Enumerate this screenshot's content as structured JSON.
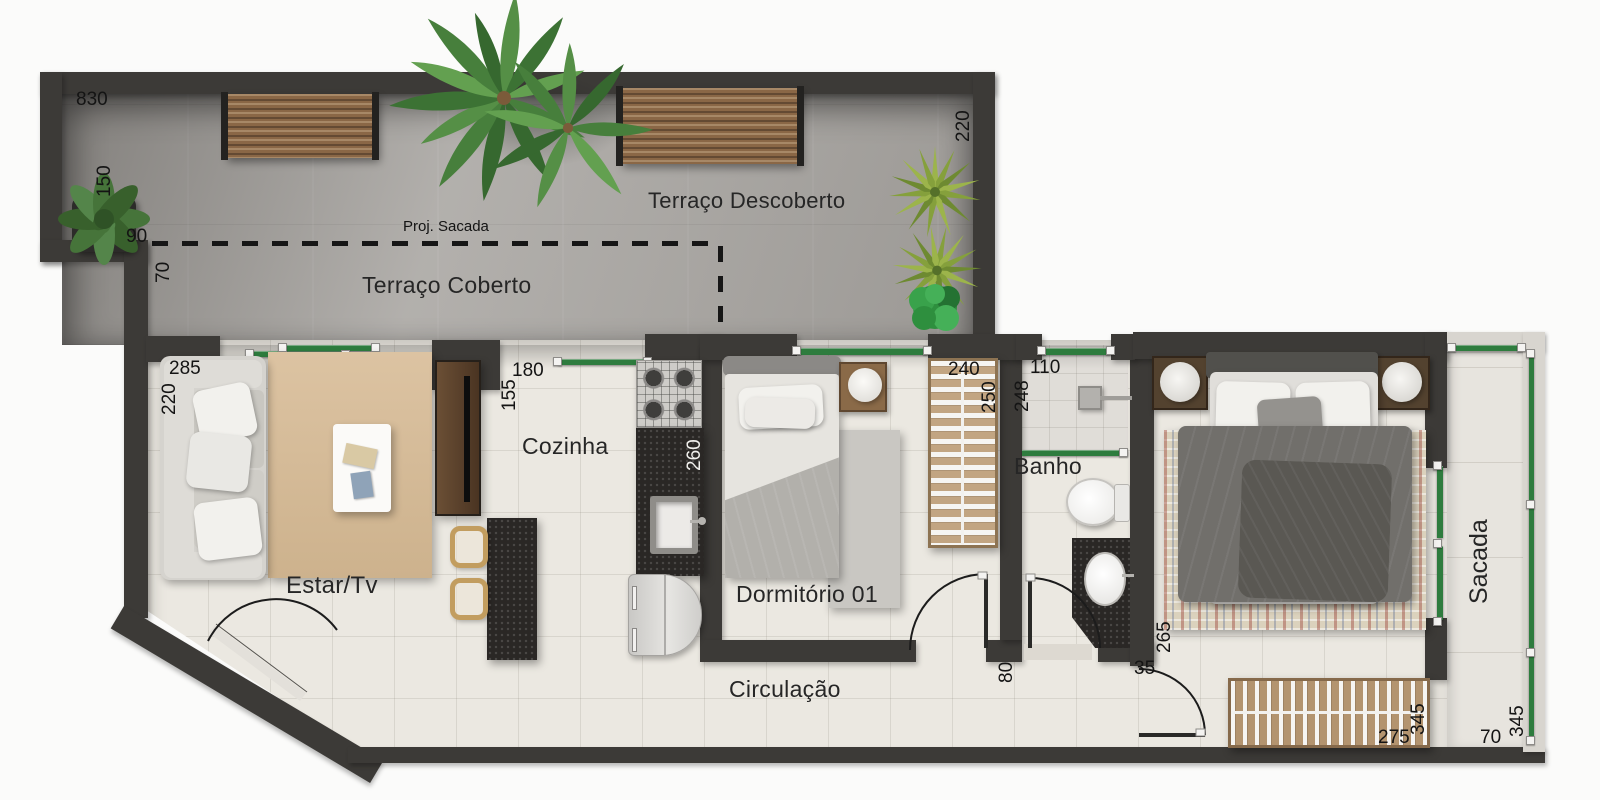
{
  "page": {
    "type": "architectural-floor-plan",
    "language": "pt-BR"
  },
  "labels": {
    "terraco_descoberto": "Terraço Descoberto",
    "terraco_coberto": "Terraço Coberto",
    "proj_sacada": "Proj. Sacada",
    "estar_tv": "Estar/Tv",
    "cozinha": "Cozinha",
    "dormitorio_01": "Dormitório 01",
    "banho": "Banho",
    "circulacao": "Circulação",
    "sacada": "Sacada"
  },
  "dims": {
    "terrace_width": "830",
    "terrace_left": "150",
    "terrace_right": "220",
    "step_width": "90",
    "step_depth": "70",
    "estar_width": "285",
    "estar_depth": "220",
    "cozinha_width": "180",
    "cozinha_left": "155",
    "counter_len": "260",
    "closet1_width": "240",
    "closet1_side": "250",
    "banho_width": "110",
    "banho_depth": "248",
    "circ_width": "80",
    "door_jamb": "35",
    "dorm2_side": "265",
    "closet2_width": "275",
    "dorm2_width": "345",
    "sacada_len": "345",
    "sacada_width": "70"
  },
  "colors": {
    "wall": "#3c3a37",
    "glass_green": "#2e7c3e",
    "terrace_floor": "#aaa7a3",
    "apartment_floor": "#ebe8e1",
    "bench_wood": "#8a6746",
    "rug_living": "#d6bd9c",
    "granite": "#2a2725",
    "label_text": "#141414"
  },
  "furniture": [
    "garden-bench",
    "palm-tree",
    "fern-plant",
    "yucca-plant",
    "round-bush",
    "sofa",
    "throw-pillows",
    "living-rug",
    "coffee-table",
    "tv-console",
    "dining-table",
    "dining-chair",
    "stove",
    "kitchen-counter",
    "kitchen-sink",
    "refrigerator",
    "single-bed",
    "nightstand",
    "bedroom-rug",
    "open-wardrobe",
    "shower-head",
    "shower-glass",
    "toilet",
    "bathroom-vanity",
    "vanity-sink",
    "double-bed",
    "bed-lamps",
    "patterned-rug",
    "door-swing"
  ]
}
